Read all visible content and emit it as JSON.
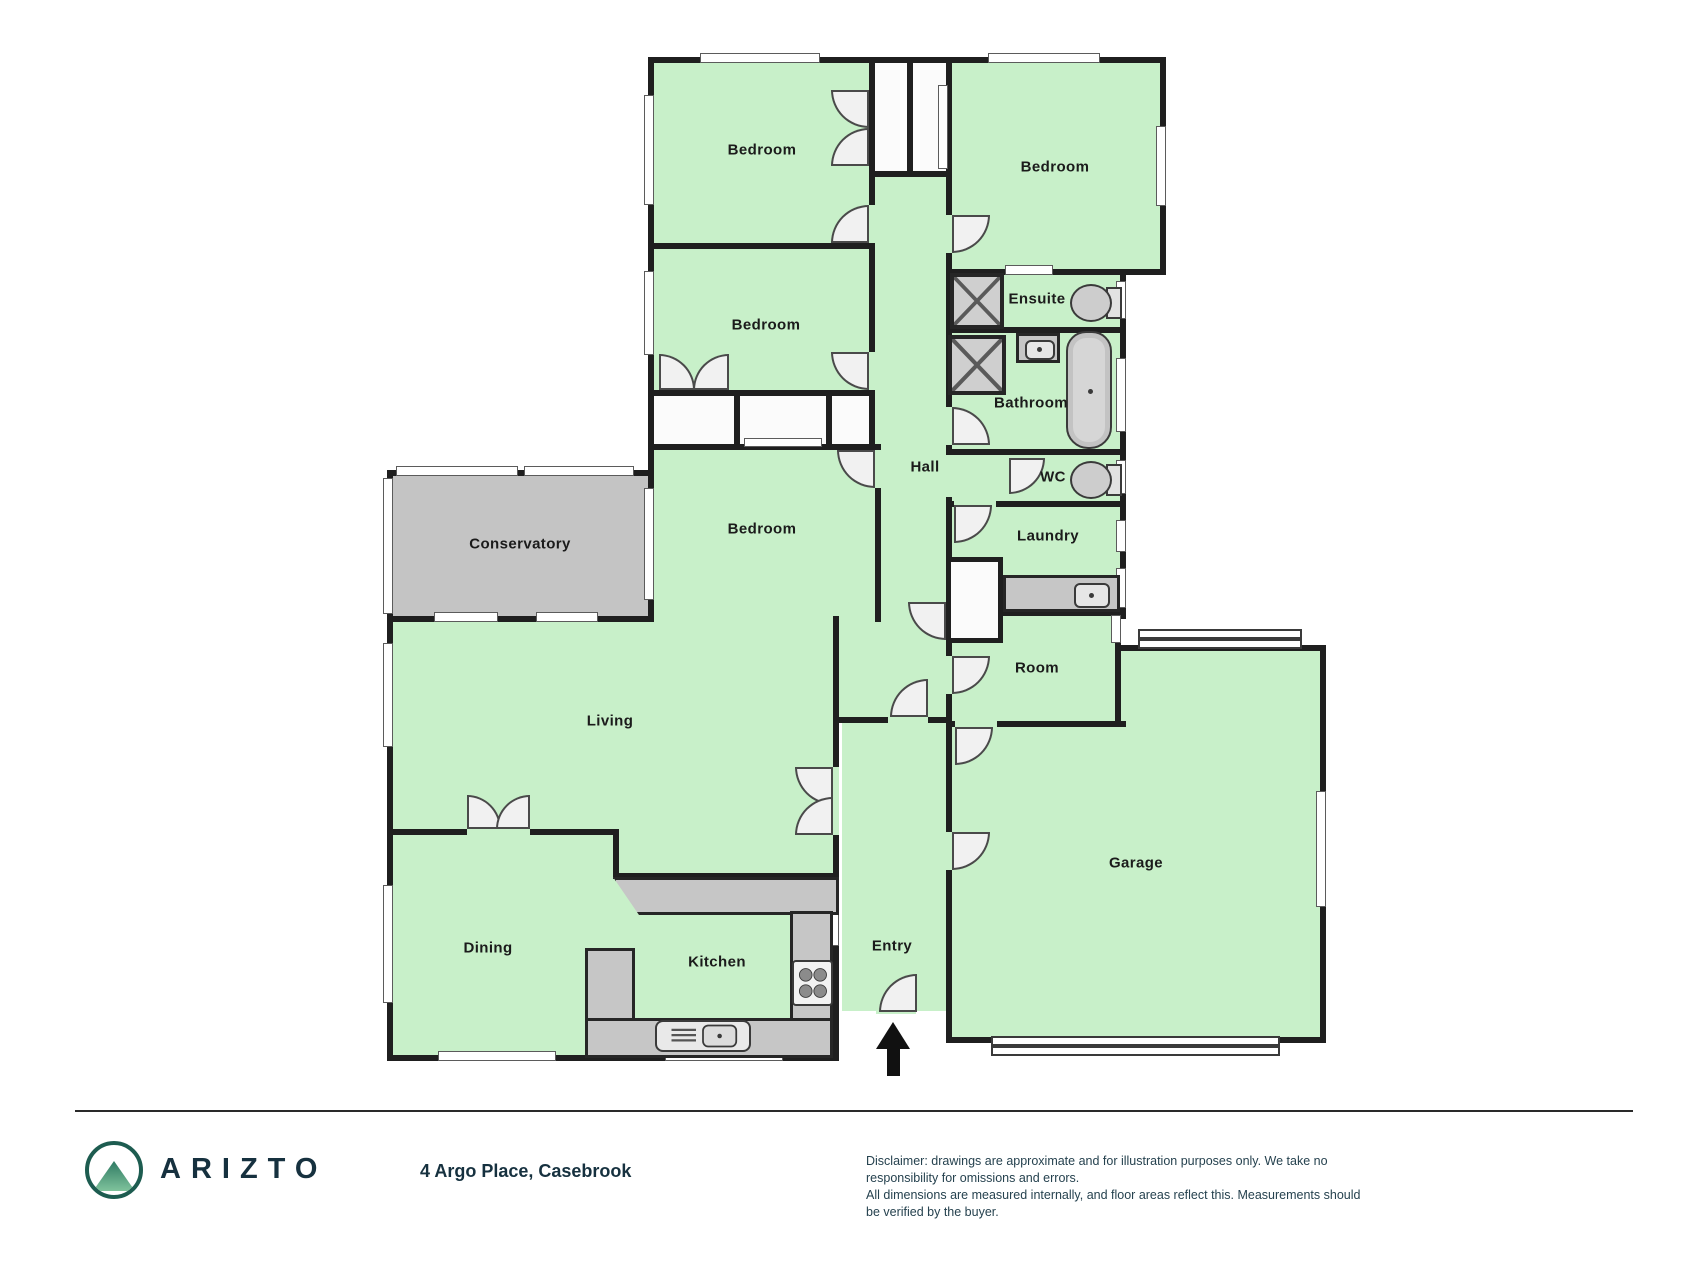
{
  "floorplan": {
    "rooms": [
      {
        "name": "bedroom-1",
        "label": "Bedroom"
      },
      {
        "name": "bedroom-2",
        "label": "Bedroom"
      },
      {
        "name": "bedroom-3",
        "label": "Bedroom"
      },
      {
        "name": "bedroom-4",
        "label": "Bedroom"
      },
      {
        "name": "conservatory",
        "label": "Conservatory"
      },
      {
        "name": "hall",
        "label": "Hall"
      },
      {
        "name": "ensuite",
        "label": "Ensuite"
      },
      {
        "name": "bathroom",
        "label": "Bathroom"
      },
      {
        "name": "wc",
        "label": "WC"
      },
      {
        "name": "laundry",
        "label": "Laundry"
      },
      {
        "name": "room",
        "label": "Room"
      },
      {
        "name": "living",
        "label": "Living"
      },
      {
        "name": "dining",
        "label": "Dining"
      },
      {
        "name": "kitchen",
        "label": "Kitchen"
      },
      {
        "name": "entry",
        "label": "Entry"
      },
      {
        "name": "garage",
        "label": "Garage"
      }
    ],
    "fixtures": [
      "shower",
      "shower",
      "bath",
      "toilet",
      "toilet",
      "basin",
      "laundry-tub",
      "kitchen-sink",
      "stove",
      "entry-arrow"
    ],
    "colors": {
      "floor": "#c8f0c9",
      "conservatory": "#c4c4c4",
      "wall": "#1f1f1f",
      "fixture_gray": "#c6c6c6"
    }
  },
  "footer": {
    "brand": "ARIZTO",
    "address": "4 Argo Place, Casebrook",
    "disclaimer_line1": "Disclaimer: drawings are approximate and for illustration purposes only. We take no responsibility for omissions and errors.",
    "disclaimer_line2": "All dimensions are measured internally, and floor areas reflect this. Measurements should be verified by the buyer.",
    "brand_color": "#16313f",
    "logo_green": "#2f7a63"
  }
}
